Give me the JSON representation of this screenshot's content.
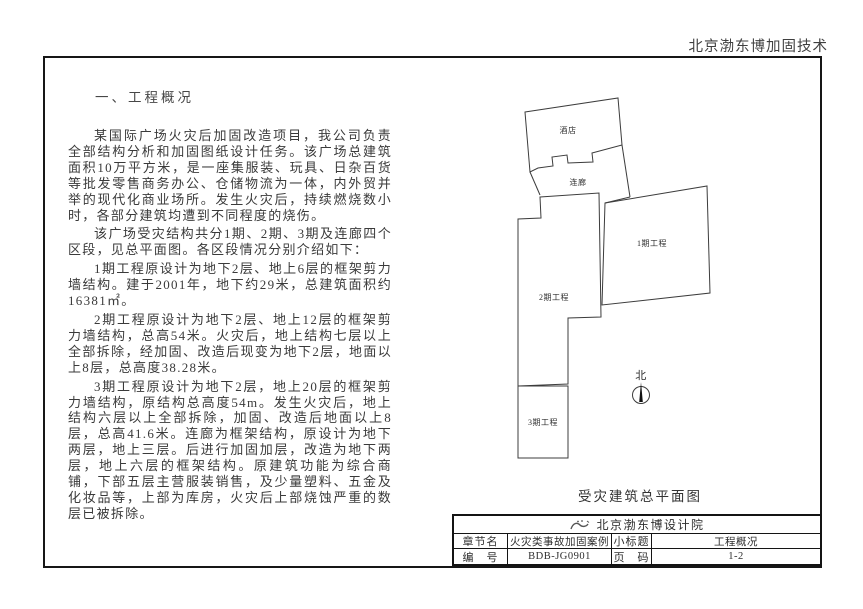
{
  "header": {
    "brand": "北京渤东博加固技术"
  },
  "document": {
    "section_title": "一、工程概况",
    "paragraphs": [
      "某国际广场火灾后加固改造项目，我公司负责全部结构分析和加固图纸设计任务。该广场总建筑面积10万平方米，是一座集服装、玩具、日杂百货等批发零售商务办公、仓储物流为一体，内外贸并举的现代化商业场所。发生火灾后，持续燃烧数小时，各部分建筑均遭到不同程度的烧伤。",
      "该广场受灾结构共分1期、2期、3期及连廊四个区段，见总平面图。各区段情况分别介绍如下：",
      "1期工程原设计为地下2层、地上6层的框架剪力墙结构。建于2001年，地下约29米，总建筑面积约16381㎡。",
      "2期工程原设计为地下2层、地上12层的框架剪力墙结构，总高54米。火灾后，地上结构七层以上全部拆除，经加固、改造后现变为地下2层，地面以上8层，总高度38.28米。",
      "3期工程原设计为地下2层，地上20层的框架剪力墙结构，原结构总高度54m。发生火灾后，地上结构六层以上全部拆除，加固、改造后地面以上8层，总高41.6米。连廊为框架结构，原设计为地下两层，地上三层。后进行加固加层，改造为地下两层，地上六层的框架结构。原建筑功能为综合商铺，下部五层主营服装销售，及少量塑料、五金及化妆品等，上部为库房，火灾后上部烧蚀严重的数层已被拆除。"
    ]
  },
  "site_plan": {
    "labels": {
      "hotel": "酒店",
      "corridor": "连廊",
      "phase1": "1期工程",
      "phase2": "2期工程",
      "phase3": "3期工程",
      "north": "北"
    },
    "caption": "受灾建筑总平面图"
  },
  "title_block": {
    "institute": "北京渤东博设计院",
    "rows": [
      {
        "label1": "章节名",
        "value1": "火灾类事故加固案例",
        "label2": "小标题",
        "value2": "工程概况"
      },
      {
        "label1": "编　号",
        "value1": "BDB-JG0901",
        "label2": "页　码",
        "value2": "1-2"
      }
    ]
  },
  "colors": {
    "line": "#3c3c3c",
    "text": "#3a3a3a",
    "border": "#161616"
  }
}
